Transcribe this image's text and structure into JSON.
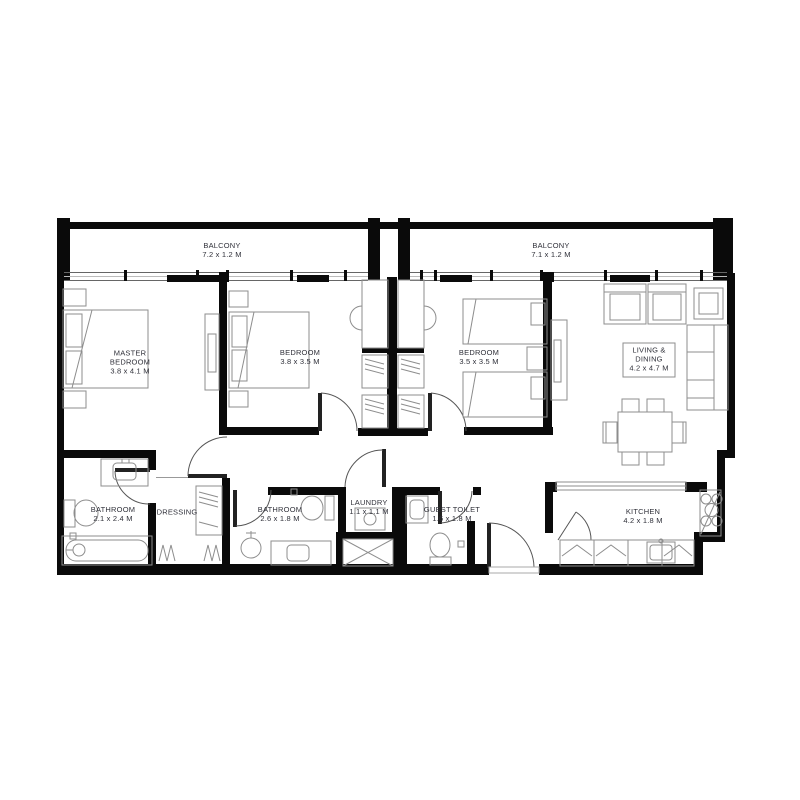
{
  "plan": {
    "type": "apartment-floor-plan",
    "rooms": [
      {
        "id": "balcony-left",
        "name": "BALCONY",
        "dims": "7.2 x 1.2 M"
      },
      {
        "id": "balcony-right",
        "name": "BALCONY",
        "dims": "7.1 x 1.2 M"
      },
      {
        "id": "master-bedroom",
        "name": "MASTER BEDROOM",
        "dims": "3.8 x 4.1 M"
      },
      {
        "id": "bedroom-2",
        "name": "BEDROOM",
        "dims": "3.8 x 3.5 M"
      },
      {
        "id": "bedroom-3",
        "name": "BEDROOM",
        "dims": "3.5 x 3.5 M"
      },
      {
        "id": "living-dining",
        "name": "LIVING & DINING",
        "dims": "4.2 x 4.7 M"
      },
      {
        "id": "bathroom-1",
        "name": "BATHROOM",
        "dims": "2.1 x 2.4 M"
      },
      {
        "id": "dressing",
        "name": "DRESSING",
        "dims": ""
      },
      {
        "id": "bathroom-2",
        "name": "BATHROOM",
        "dims": "2.6 x 1.8 M"
      },
      {
        "id": "laundry",
        "name": "LAUNDRY",
        "dims": "1.1 x 1.1 M"
      },
      {
        "id": "guest-toilet",
        "name": "GUEST TOILET",
        "dims": "1.6 x 1.8 M"
      },
      {
        "id": "kitchen",
        "name": "KITCHEN",
        "dims": "4.2 x 1.8 M"
      }
    ],
    "fixtures": [
      "double-bed",
      "twin-beds",
      "wardrobe",
      "desk-chair",
      "bathtub",
      "shower",
      "toilet",
      "washbasin",
      "washing-machine",
      "shaft",
      "stove",
      "kitchen-sink",
      "sofa",
      "armchair",
      "side-table",
      "coffee-table",
      "dining-table",
      "tv-console",
      "entry-door"
    ],
    "colors": {
      "wall": "#0a0a0a",
      "furniture": "#8d8d8d",
      "door": "#555555",
      "text": "#30313a",
      "background": "#ffffff"
    }
  }
}
